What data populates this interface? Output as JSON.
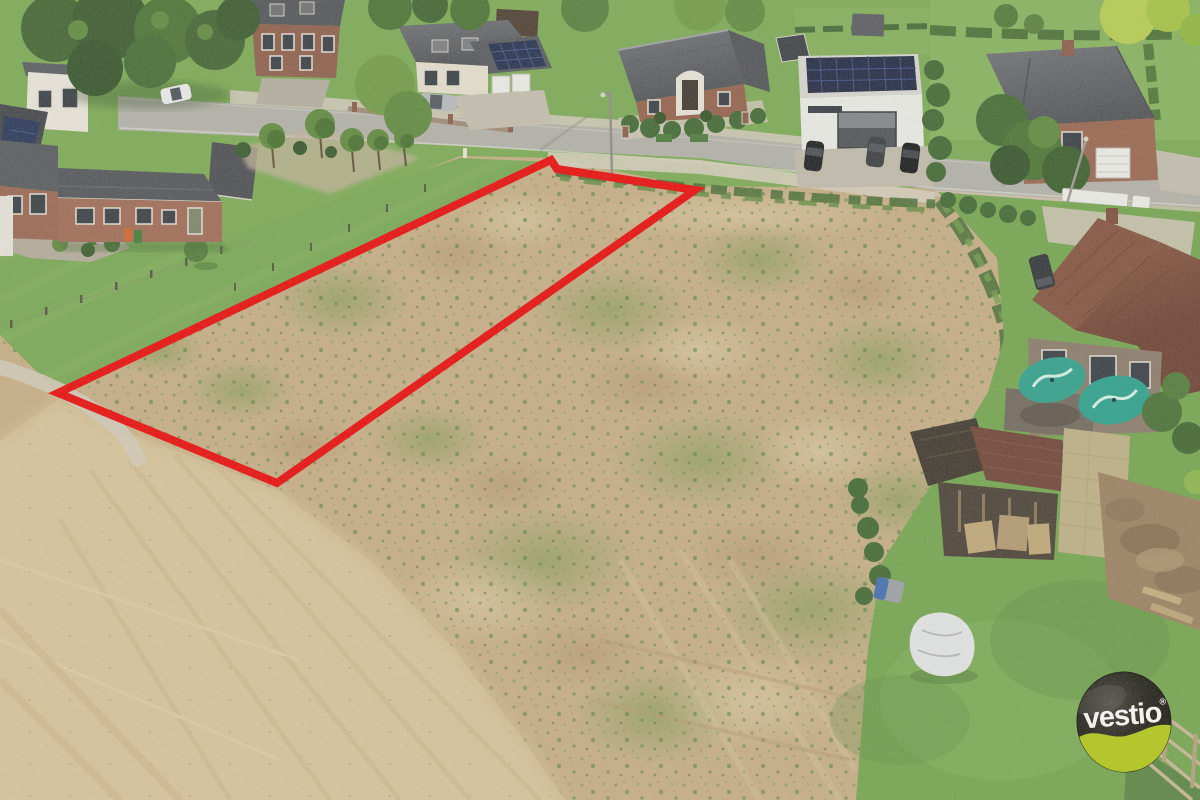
{
  "image": {
    "kind": "aerial-drone-photo",
    "subject": "Vacant building plot for sale outlined in red, bare sandy field along a residential street with detached houses, gardens, barn and lawns",
    "view": "oblique top-down"
  },
  "branding": {
    "logo_text": "vestio",
    "registered_mark": "®",
    "colors": {
      "egg_black": "#16160e",
      "accent_lime": "#b3cb13",
      "text_white": "#ffffff"
    }
  },
  "parcel": {
    "outline_color": "#ee0404",
    "stroke_width": 8,
    "points": "58,393 551,160 557,169 695,190 277,483",
    "shape": "long narrow strip running diagonally across the bare field"
  },
  "palette": {
    "dirt": "#c9b086",
    "sand": "#dbc79d",
    "lawn": "#74a850",
    "hedge": "#3c672f",
    "road": "#b4b4ac",
    "gravel": "#d3ccbb",
    "roof_gray": "#54585c",
    "roof_brown": "#7a4a38",
    "brick": "#96604a",
    "white_wall": "#f0efe9",
    "solar_panel": "#1d2a49",
    "parasol_teal": "#2aa18d",
    "tarp_white": "#e6e9ea",
    "red_outline": "#ee0404"
  },
  "scene": {
    "street": "residential road running along the top of the frame",
    "objects": [
      "white house with rooftop solar panels",
      "brick house with gray roof and dormers",
      "cream house with double garage and solar array",
      "brick house with arched white facade",
      "modern flat-roof house with solar panels and three parked cars",
      "two-storey brick house with white garage door and large tree",
      "brick farmhouse with two teal patio parasols",
      "old barn with weathered dark and red tiled roofs",
      "white tarp on lawn",
      "robotic lawn mower",
      "row of pollarded trees on grass verge",
      "street lamps",
      "garden fence posts and wire fence",
      "tyre tracks in bare soil",
      "wooden rail fence in bottom-right corner"
    ]
  }
}
